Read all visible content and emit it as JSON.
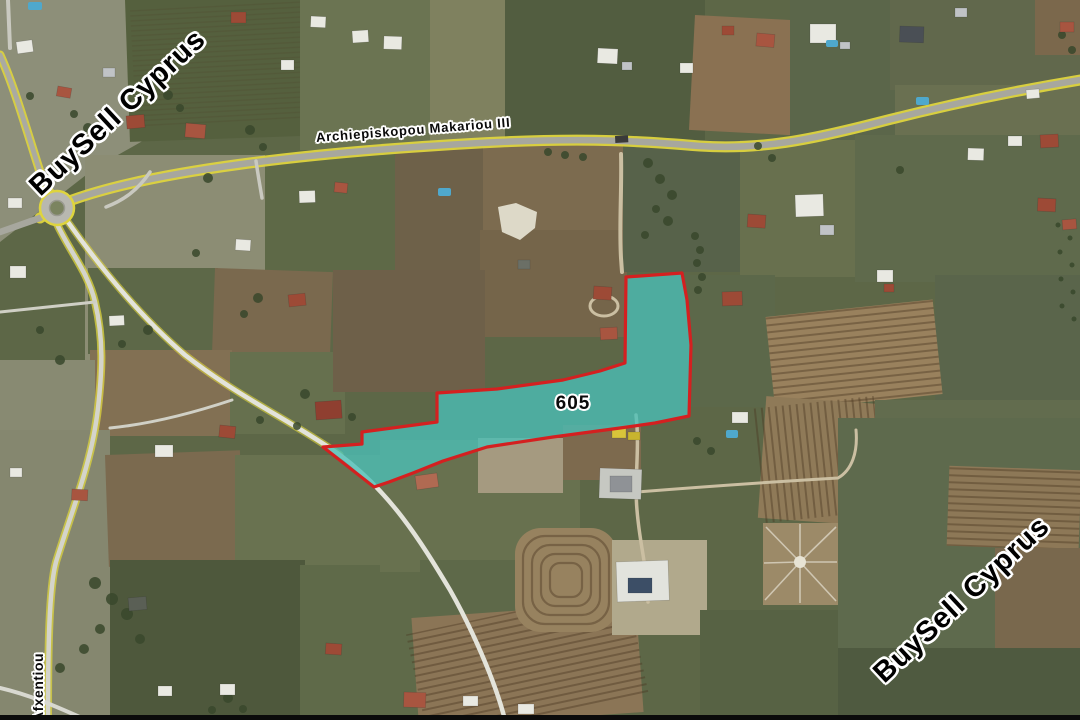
{
  "map": {
    "watermark": {
      "text": "BuySell Cyprus"
    },
    "parcel": {
      "label": "605",
      "fill_color": "rgba(74,192,184,0.78)",
      "border_color": "#d42020"
    },
    "main_road": {
      "label": "Archiepiskopou Makariou III"
    },
    "side_road": {
      "label": "Afxentiou"
    },
    "road_line_color": "#ded43e"
  }
}
